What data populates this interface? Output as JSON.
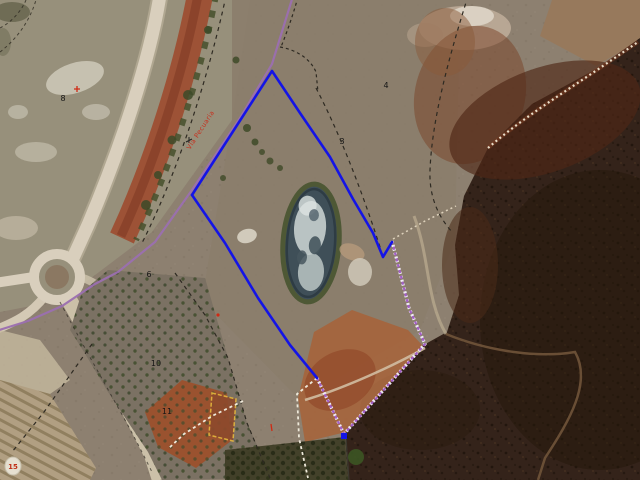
{
  "map": {
    "view": "aerial-orthophoto-with-cadastral-overlay",
    "parcel_numbers": [
      {
        "text": "8",
        "x": 63,
        "y": 101
      },
      {
        "text": "4",
        "x": 386,
        "y": 88
      },
      {
        "text": "3",
        "x": 342,
        "y": 144
      },
      {
        "text": "6",
        "x": 149,
        "y": 277
      },
      {
        "text": "10",
        "x": 156,
        "y": 366
      },
      {
        "text": "11",
        "x": 167,
        "y": 414
      }
    ],
    "route_label": {
      "text": "Vía Pecuaria",
      "x": 190,
      "y": 150,
      "rotation": -57,
      "color": "#c6311f"
    },
    "landmark_marker": {
      "text": "15",
      "x": 13,
      "y": 469,
      "color": "#c03018"
    },
    "overlay": {
      "selected_parcel_color": "#1414e6",
      "route_line_color": "#9b6fb0",
      "route_dashed_color": "#a35fc7",
      "parcel_line_color": "#2e2a22",
      "white_dash_color": "#eee9da",
      "highlight_parcel_color": "#e5b63c",
      "number_color": "#151515"
    }
  }
}
